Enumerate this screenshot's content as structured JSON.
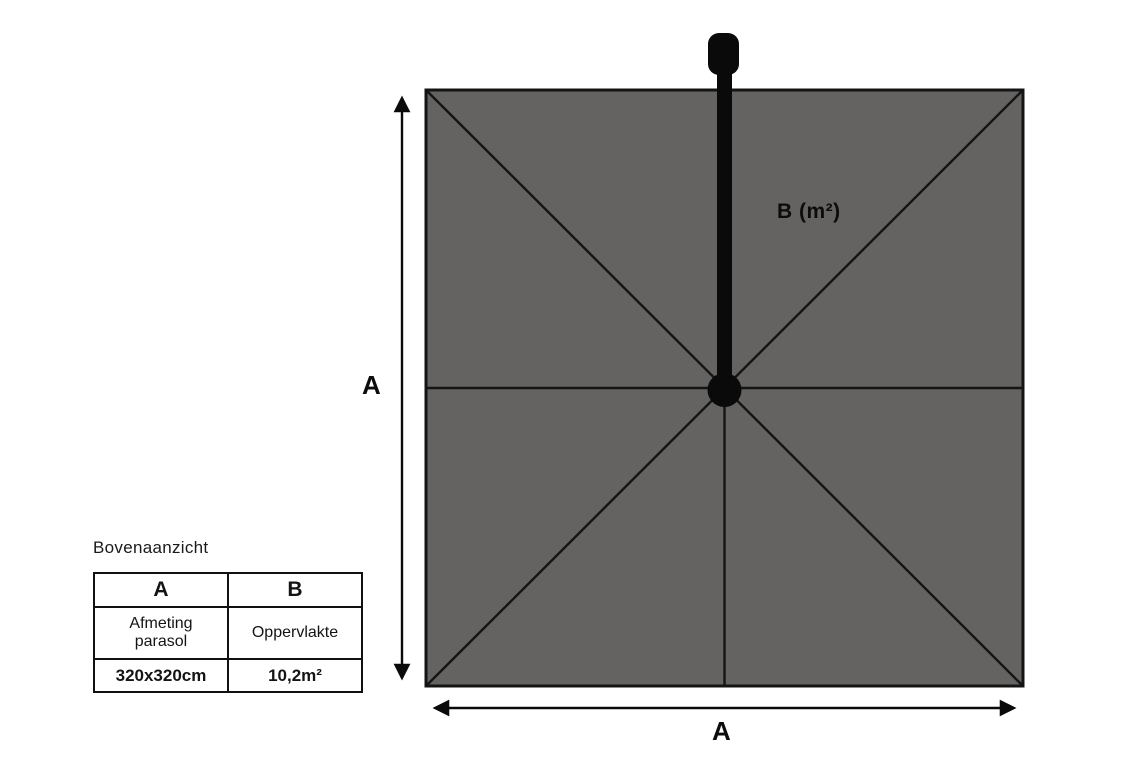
{
  "diagram": {
    "title": "Bovenaanzicht",
    "label_b": "B (m²)",
    "label_a_left": "A",
    "label_a_bottom": "A"
  },
  "table": {
    "headers": [
      "A",
      "B"
    ],
    "desc_row": [
      "Afmeting parasol",
      "Oppervlakte"
    ],
    "value_row": [
      "320x320cm",
      "10,2m²"
    ]
  },
  "colors": {
    "canopy_gray": "#646361",
    "line_black": "#141414",
    "solid_black": "#0a0a0a"
  }
}
